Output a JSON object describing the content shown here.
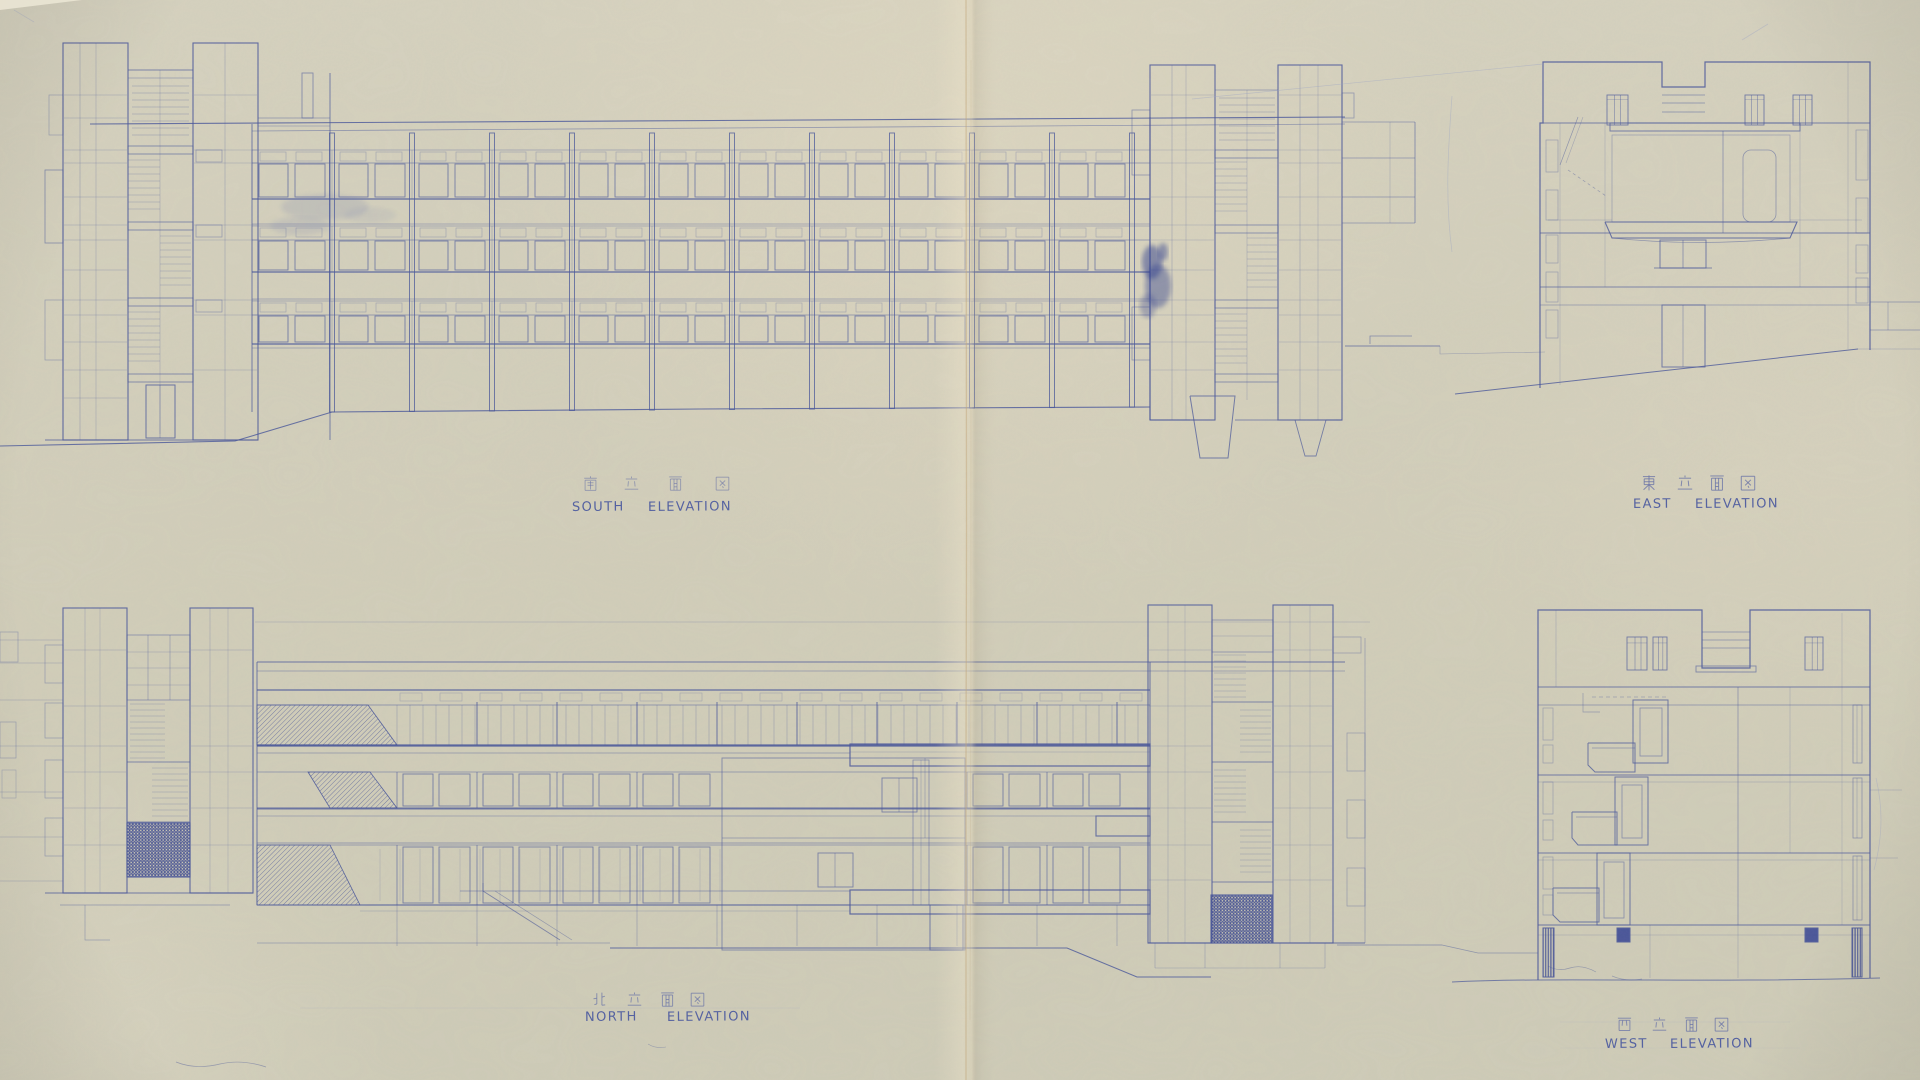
{
  "sheet": {
    "kind": "scanned architectural blueprint",
    "width": 1920,
    "height": 1080,
    "drawings": [
      "south elevation",
      "east elevation",
      "north elevation",
      "west elevation"
    ]
  },
  "colors": {
    "paper": "#d3cfbb",
    "paper_light": "#e6ddc6",
    "ink": "#46549a",
    "ink_faint": "#7b85b4",
    "ink_pale": "#9ba3c6",
    "ink_dark": "#2c3b8e",
    "crease": "#c3a87c",
    "hatch": "#3a4896"
  },
  "labels": {
    "south": {
      "kanji": "南立面図",
      "kanji_chars": [
        "南",
        "立",
        "面",
        "図"
      ],
      "english": "SOUTH ELEVATION",
      "english_words": [
        "SOUTH",
        "ELEVATION"
      ],
      "kanji_xs": [
        583,
        624,
        668,
        715
      ],
      "kanji_y": 476,
      "kanji_size": 15,
      "kanji_opacity": 0.55,
      "words_x": [
        572,
        648
      ],
      "baseline_y": 511
    },
    "east": {
      "kanji": "東立面図",
      "kanji_chars": [
        "東",
        "立",
        "面",
        "図"
      ],
      "english": "EAST ELEVATION",
      "english_words": [
        "EAST",
        "ELEVATION"
      ],
      "kanji_xs": [
        1641,
        1677,
        1709,
        1740
      ],
      "kanji_y": 475,
      "kanji_size": 16,
      "kanji_opacity": 0.8,
      "words_x": [
        1633,
        1695
      ],
      "baseline_y": 508
    },
    "north": {
      "kanji": "北立面図",
      "kanji_chars": [
        "北",
        "立",
        "面",
        "図"
      ],
      "english": "NORTH ELEVATION",
      "english_words": [
        "NORTH",
        "ELEVATION"
      ],
      "kanji_xs": [
        592,
        627,
        660,
        690
      ],
      "kanji_y": 992,
      "kanji_size": 15,
      "kanji_opacity": 0.7,
      "words_x": [
        585,
        667
      ],
      "baseline_y": 1021
    },
    "west": {
      "kanji": "西立面図",
      "kanji_chars": [
        "西",
        "立",
        "面",
        "図"
      ],
      "english": "WEST ELEVATION",
      "english_words": [
        "WEST",
        "ELEVATION"
      ],
      "kanji_xs": [
        1617,
        1652,
        1684,
        1714
      ],
      "kanji_y": 1017,
      "kanji_size": 15,
      "kanji_opacity": 0.75,
      "words_x": [
        1605,
        1670
      ],
      "baseline_y": 1048
    }
  },
  "drawing_spec": {
    "south": {
      "facade_x": [
        252,
        1150
      ],
      "bay": 80,
      "roof": [
        [
          90,
          124
        ],
        [
          1345,
          117
        ]
      ],
      "parapet2": [
        [
          252,
          131
        ],
        [
          1345,
          124
        ]
      ],
      "bands": [
        {
          "t": [
            150,
            163
          ],
          "w": [
            164,
            197
          ],
          "s": 199,
          "slab2": 224
        },
        {
          "t": [
            226,
            239
          ],
          "w": [
            241,
            270
          ],
          "s": 272,
          "slab2": 299
        },
        {
          "t": [
            301,
            314
          ],
          "w": [
            316,
            342
          ],
          "s": 344,
          "slab2": 348
        }
      ],
      "posts_from": 332,
      "posts_step": 80,
      "posts_to": 1132,
      "ground": [
        [
          0,
          446
        ],
        [
          235,
          441
        ],
        [
          332,
          412
        ],
        [
          700,
          409
        ],
        [
          1150,
          407
        ]
      ],
      "left_towers": {
        "t1": [
          63,
          128
        ],
        "gap": [
          128,
          193
        ],
        "t2": [
          193,
          258
        ],
        "attach": 330,
        "top": 43,
        "bottom": 440
      },
      "right_towers": {
        "t3": [
          1150,
          1215
        ],
        "gap": [
          1215,
          1278
        ],
        "t4": [
          1278,
          1342
        ],
        "top": 65,
        "bottom": 420
      }
    },
    "east": {
      "box": [
        1540,
        62,
        1870,
        350
      ],
      "notch": [
        1662,
        1705,
        87
      ],
      "floors": [
        123,
        233,
        287,
        305
      ],
      "ground": [
        [
          1455,
          394
        ],
        [
          1858,
          349
        ]
      ]
    },
    "north": {
      "facade_x": [
        257,
        1150
      ],
      "roof_y": 662,
      "top_y": 690,
      "bands": [
        {
          "w": [
            705,
            745
          ],
          "hatch": [
            [
              257,
              705
            ],
            [
              368,
              705
            ],
            [
              397,
              745
            ],
            [
              257,
              745
            ]
          ]
        },
        {
          "w": [
            772,
            808
          ],
          "hatch": [
            [
              308,
              772
            ],
            [
              370,
              772
            ],
            [
              397,
              808
            ],
            [
              330,
              808
            ]
          ]
        },
        {
          "w": [
            845,
            905
          ],
          "hatch": [
            [
              257,
              845
            ],
            [
              330,
              845
            ],
            [
              360,
              905
            ],
            [
              257,
              905
            ]
          ]
        }
      ],
      "panel": [
        722,
        758,
        243,
        192
      ],
      "left_towers": {
        "t1": [
          63,
          127
        ],
        "gap": [
          127,
          190
        ],
        "t2": [
          190,
          253
        ],
        "top": 608,
        "bottom": 893
      },
      "right_towers": {
        "t5": [
          1148,
          1212
        ],
        "gap": [
          1212,
          1273
        ],
        "t6": [
          1273,
          1333
        ],
        "top": 605,
        "bottom": 943
      },
      "grilles": [
        [
          127,
          823,
          63,
          54
        ],
        [
          1211,
          895,
          61,
          48
        ]
      ],
      "ground": [
        [
          610,
          948
        ],
        [
          1067,
          948
        ],
        [
          1137,
          977
        ],
        [
          1211,
          977
        ]
      ]
    },
    "west": {
      "box": [
        1538,
        610,
        1870,
        978
      ],
      "notch": [
        1702,
        1750,
        668
      ],
      "floors": [
        687,
        705,
        775,
        782,
        853,
        860,
        925,
        935
      ],
      "balconies": [
        {
          "box": [
            1633,
            700,
            35,
            63
          ],
          "win": [
            1640,
            708,
            22,
            48
          ],
          "deck": [
            [
              1588,
              743
            ],
            [
              1635,
              743
            ],
            [
              1635,
              772
            ],
            [
              1595,
              772
            ],
            [
              1588,
              765
            ]
          ]
        },
        {
          "box": [
            1615,
            777,
            33,
            68
          ],
          "win": [
            1622,
            785,
            20,
            53
          ],
          "deck": [
            [
              1572,
              812
            ],
            [
              1617,
              812
            ],
            [
              1617,
              845
            ],
            [
              1578,
              845
            ],
            [
              1572,
              838
            ]
          ]
        },
        {
          "box": [
            1597,
            853,
            33,
            72
          ],
          "win": [
            1604,
            862,
            20,
            56
          ],
          "deck": [
            [
              1553,
              888
            ],
            [
              1599,
              888
            ],
            [
              1599,
              922
            ],
            [
              1560,
              922
            ],
            [
              1553,
              915
            ]
          ]
        }
      ],
      "pillars": [
        [
          1543,
          928,
          11,
          49
        ],
        [
          1617,
          928,
          13,
          14
        ],
        [
          1805,
          928,
          13,
          14
        ],
        [
          1852,
          928,
          10,
          49
        ]
      ]
    }
  }
}
